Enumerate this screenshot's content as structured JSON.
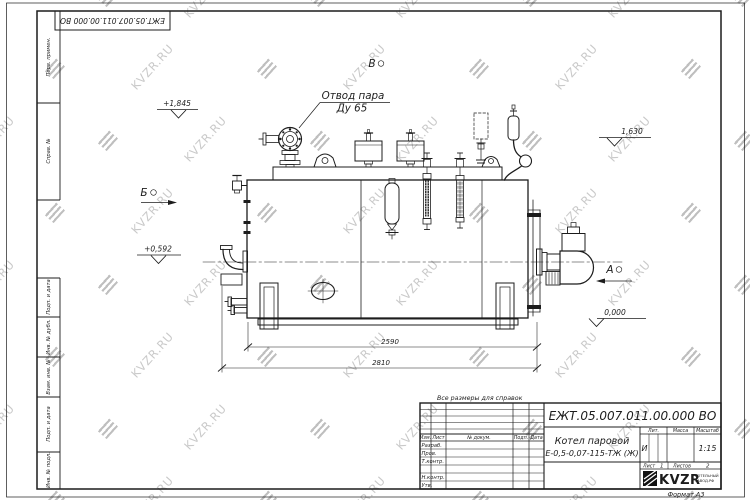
{
  "sheet": {
    "top_stamp": "ЕЖТ.05.007.011.00.000  ВО",
    "reference_note": "Все размеры для справок",
    "format_label": "Формат А3"
  },
  "watermark": {
    "text": "KVZR.RU",
    "color": "#c9c9c9"
  },
  "margin_labels": [
    "Перв. примен.",
    "Справ. №",
    "Подп. и дата",
    "Инв. № дубл.",
    "Взам. инв. №",
    "Подп. и дата",
    "Инв. № подл."
  ],
  "title_block": {
    "doc_number": "ЕЖТ.05.007.011.00.000  ВО",
    "product_name_line1": "Котел паровой",
    "product_name_line2": "Е-0,5-0,07-115-ТЖ (Ж)",
    "header_cols": [
      "Изм.",
      "Лист",
      "№ докум.",
      "Подп.",
      "Дата"
    ],
    "row_labels": [
      "Разраб.",
      "Пров.",
      "Т.контр.",
      "Н.контр.",
      "Утв."
    ],
    "lit_header": "Лит.",
    "mass_header": "Масса",
    "scale_header": "Масштаб",
    "lit_value": "И",
    "scale_value": "1:15",
    "sheet_label": "Лист",
    "sheet_value": "1",
    "sheets_label": "Листов",
    "sheets_value": "2",
    "logo_text": "KVZR",
    "logo_sub1": "КОТЕЛЬНЫЙ",
    "logo_sub2": "ЗАВОД.РФ"
  },
  "annotations": {
    "steam_outlet_line1": "Отвод пара",
    "steam_outlet_line2": "Ду 65",
    "view_a": "А",
    "view_b": "Б",
    "view_v": "В",
    "level_top": "+1,845",
    "level_right": "1,630",
    "level_left": "+0,592",
    "level_zero": "0,000",
    "dim_inner": "2590",
    "dim_overall": "2810"
  }
}
